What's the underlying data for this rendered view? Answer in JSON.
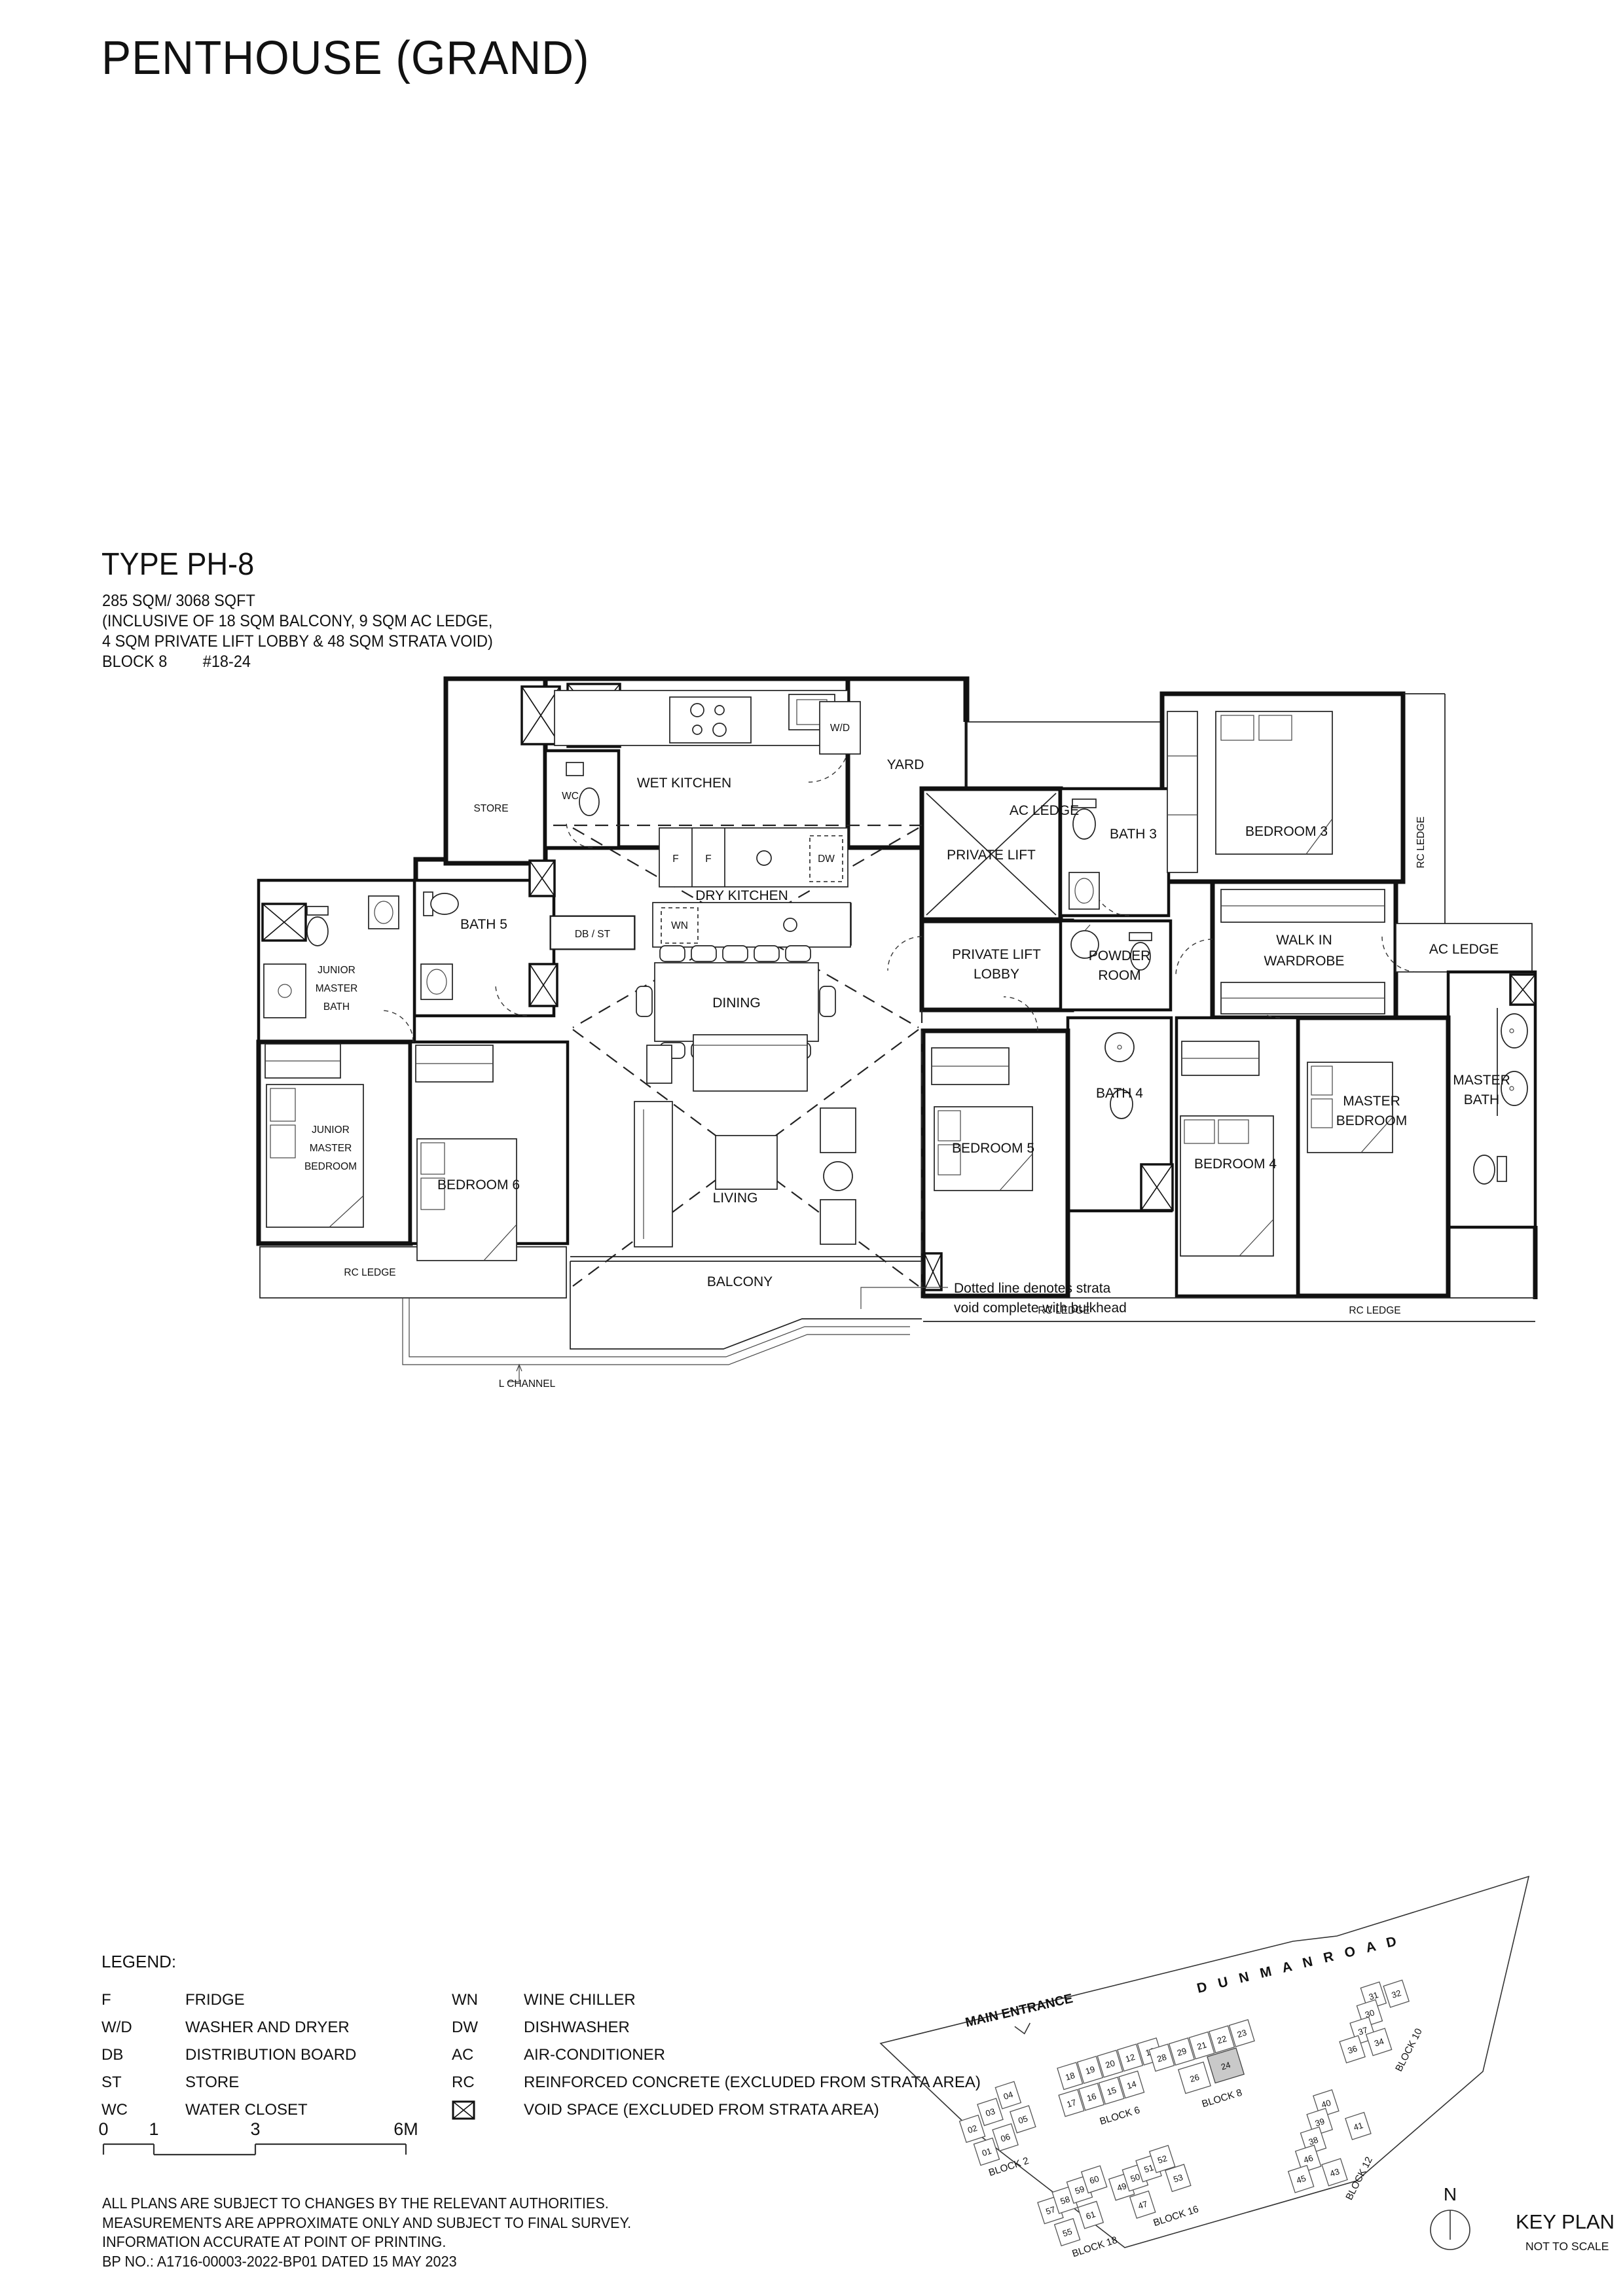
{
  "page": {
    "title": "PENTHOUSE (GRAND)",
    "type_title": "TYPE PH-8",
    "area": "285 SQM/ 3068 SQFT",
    "inclusive1": "(INCLUSIVE OF 18 SQM BALCONY, 9 SQM AC LEDGE,",
    "inclusive2": "4 SQM PRIVATE LIFT LOBBY & 48 SQM STRATA VOID)",
    "block": "BLOCK 8",
    "unit_no": "#18-24"
  },
  "plan": {
    "labels": {
      "store": "STORE",
      "wc": "WC",
      "wet_kitchen": "WET KITCHEN",
      "washer_dryer": "W/D",
      "yard": "YARD",
      "ac_ledge": "AC LEDGE",
      "rc_ledge": "RC LEDGE",
      "bedroom3": "BEDROOM 3",
      "private_lift": "PRIVATE LIFT",
      "lobby_l1": "PRIVATE LIFT",
      "lobby_l2": "LOBBY",
      "bath3": "BATH 3",
      "powder_l1": "POWDER",
      "powder_l2": "ROOM",
      "walkin_l1": "WALK IN",
      "walkin_l2": "WARDROBE",
      "db_st": "DB / ST",
      "fridge": "F",
      "wine_chiller": "WN",
      "dishwasher": "DW",
      "dry_kitchen": "DRY KITCHEN",
      "dining": "DINING",
      "living": "LIVING",
      "balcony": "BALCONY",
      "l_channel": "L CHANNEL",
      "junior_l1": "JUNIOR",
      "junior_l2": "MASTER",
      "junior_bath_l3": "BATH",
      "junior_bed_l3": "BEDROOM",
      "bath5": "BATH 5",
      "bedroom6": "BEDROOM 6",
      "bedroom5": "BEDROOM 5",
      "bath4": "BATH 4",
      "bedroom4": "BEDROOM 4",
      "master_l1": "MASTER",
      "master_bed_l2": "BEDROOM",
      "master_bath_l2": "BATH"
    },
    "note_l1": "Dotted line denotes strata",
    "note_l2": "void complete with bulkhead"
  },
  "legend": {
    "title": "LEGEND:",
    "left": [
      {
        "abbr": "F",
        "desc": "FRIDGE"
      },
      {
        "abbr": "W/D",
        "desc": "WASHER AND DRYER"
      },
      {
        "abbr": "DB",
        "desc": "DISTRIBUTION BOARD"
      },
      {
        "abbr": "ST",
        "desc": "STORE"
      },
      {
        "abbr": "WC",
        "desc": "WATER CLOSET"
      }
    ],
    "right": [
      {
        "abbr": "WN",
        "desc": "WINE CHILLER"
      },
      {
        "abbr": "DW",
        "desc": "DISHWASHER"
      },
      {
        "abbr": "AC",
        "desc": "AIR-CONDITIONER"
      },
      {
        "abbr": "RC",
        "desc": "REINFORCED CONCRETE (EXCLUDED FROM STRATA AREA)"
      },
      {
        "abbr": "",
        "desc": "VOID SPACE (EXCLUDED FROM STRATA AREA)"
      }
    ]
  },
  "scalebar": {
    "t0": "0",
    "t1": "1",
    "t3": "3",
    "t6": "6M"
  },
  "disclaimer": {
    "l1": "ALL PLANS ARE SUBJECT TO CHANGES BY THE RELEVANT AUTHORITIES.",
    "l2": "MEASUREMENTS ARE APPROXIMATE ONLY AND SUBJECT TO FINAL SURVEY.",
    "l3": "INFORMATION ACCURATE AT POINT OF PRINTING.",
    "l4": "BP NO.: A1716-00003-2022-BP01 DATED 15 MAY 2023"
  },
  "keyplan": {
    "main_entrance": "MAIN ENTRANCE",
    "road": "D U N M A N    R O A D",
    "north": "N",
    "title": "KEY PLAN",
    "subtitle": "NOT TO SCALE",
    "highlighted_unit": "24",
    "blocks": {
      "block2": {
        "label": "BLOCK 2",
        "units": [
          "02",
          "03",
          "04",
          "01",
          "06",
          "05"
        ]
      },
      "block6": {
        "label": "BLOCK 6",
        "units": [
          "18",
          "19",
          "20",
          "12",
          "13",
          "17",
          "16",
          "15",
          "14"
        ]
      },
      "block8": {
        "label": "BLOCK 8",
        "units": [
          "28",
          "29",
          "21",
          "22",
          "23",
          "26",
          "24"
        ]
      },
      "block10": {
        "label": "BLOCK 10",
        "units": [
          "31",
          "32",
          "30",
          "37",
          "36",
          "34"
        ]
      },
      "block12": {
        "label": "BLOCK 12",
        "units": [
          "40",
          "39",
          "38",
          "46",
          "45",
          "43",
          "41"
        ]
      },
      "block16": {
        "label": "BLOCK 16",
        "units": [
          "49",
          "50",
          "51",
          "52",
          "47",
          "53"
        ]
      },
      "block18": {
        "label": "BLOCK 18",
        "units": [
          "57",
          "58",
          "59",
          "60",
          "55",
          "61"
        ]
      }
    }
  }
}
